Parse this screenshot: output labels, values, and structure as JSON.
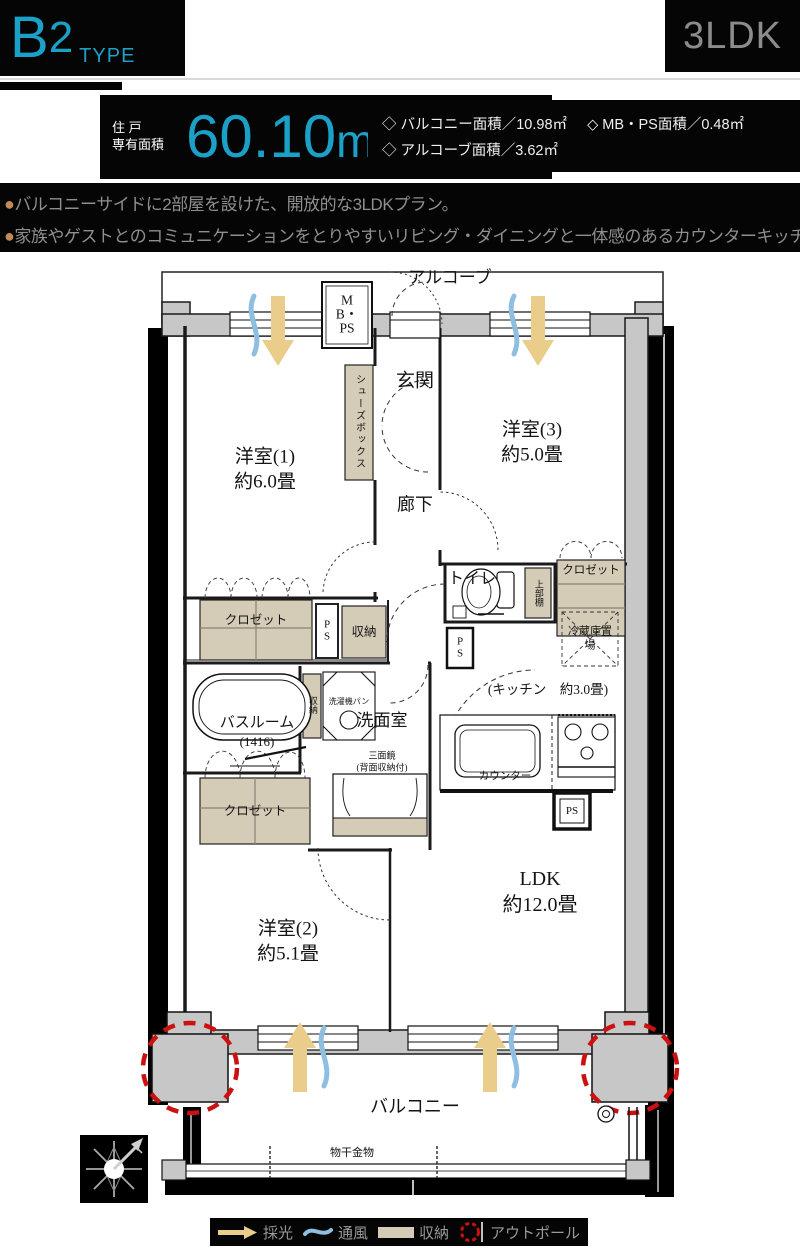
{
  "header": {
    "type_main": "B",
    "type_num": "2",
    "type_sub": "TYPE",
    "layout": "3LDK"
  },
  "area": {
    "label_line1": "住 戸",
    "label_line2": "専有面積",
    "value": "60.10",
    "unit": "m",
    "unit_sup": "2"
  },
  "details": {
    "items": [
      "◇ バルコニー面積／10.98㎡",
      "◇ MB・PS面積／0.48㎡",
      "◇ アルコーブ面積／3.62㎡"
    ]
  },
  "features": {
    "bullet": "●",
    "lines": [
      "バルコニーサイドに2部屋を設けた、開放的な3LDKプラン。",
      "家族やゲストとのコミュニケーションをとりやすいリビング・ダイニングと一体感のあるカウンターキッチン。"
    ]
  },
  "floorplan": {
    "alcove": "アルコーブ",
    "mb_ps": "MB・PS",
    "shoes_box": "シューズボックス",
    "entrance": "玄関",
    "room1": {
      "name": "洋室(1)",
      "size": "約6.0畳"
    },
    "room3": {
      "name": "洋室(3)",
      "size": "約5.0畳"
    },
    "corridor": "廊下",
    "toilet": "トイレ",
    "upper_shelf": "上部棚",
    "closet1": "クロゼット",
    "closet2": "クロゼット",
    "closet3": "クロゼット",
    "fridge": "冷蔵庫置場",
    "ps1": "PS",
    "ps2": "PS",
    "ps3": "PS",
    "storage1": "収納",
    "storage2": "収納",
    "bathroom": {
      "name": "バスルーム",
      "size": "(1416)"
    },
    "laundry_pan": "洗濯機パン",
    "washroom": "洗面室",
    "mirror_line1": "三面鏡",
    "mirror_line2": "(背面収納付)",
    "kitchen": "(キッチン　約3.0畳)",
    "counter": "カウンター",
    "ldk": {
      "name": "LDK",
      "size": "約12.0畳"
    },
    "room2": {
      "name": "洋室(2)",
      "size": "約5.1畳"
    },
    "balcony": "バルコニー",
    "laundry_hw": "物干金物"
  },
  "legend": {
    "items": [
      {
        "icon": "daylight-arrow",
        "label": "採光"
      },
      {
        "icon": "wind-wave",
        "label": "通風"
      },
      {
        "icon": "storage-swatch",
        "label": "収納"
      },
      {
        "icon": "outpole-circle",
        "label": "アウトポール"
      }
    ]
  },
  "colors": {
    "accent": "#1BA0C8",
    "storage": "#D5CCB7",
    "daylight": "#EBCD8B",
    "wind": "#8FBFE0",
    "outpole": "#CC1111"
  }
}
